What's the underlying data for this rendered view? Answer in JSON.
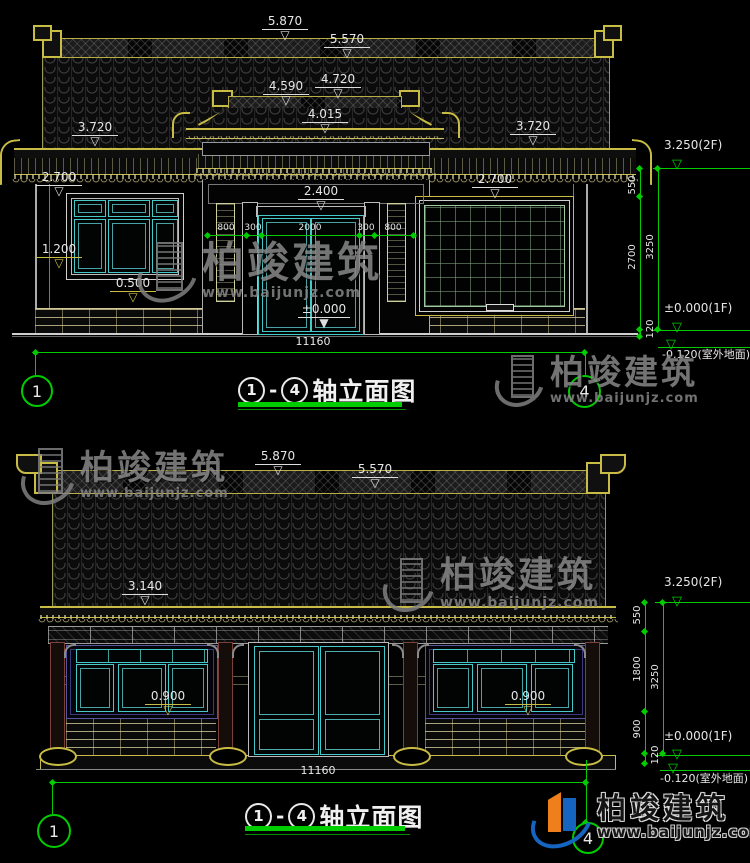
{
  "brand": {
    "name": "柏竣建筑",
    "url": "www.baijunjz.com"
  },
  "top": {
    "title": {
      "n1": "1",
      "dash": "-",
      "n2": "4",
      "label": "轴立面图"
    },
    "levels": {
      "v5870": "5.870",
      "v5570": "5.570",
      "v4720": "4.720",
      "v4590": "4.590",
      "v4015": "4.015",
      "v3720": "3.720",
      "v2700": "2.700",
      "v2400": "2.400",
      "v1200": "1.200",
      "v0500": "0.500",
      "v0000": "±0.000"
    },
    "width_chain": [
      "800",
      "300",
      "2000",
      "300",
      "800"
    ],
    "total_width": "11160",
    "axis_left": "1",
    "axis_right": "4",
    "chain": {
      "level2f": "3.250(2F)",
      "s550": "550",
      "s2700": "2700",
      "total": "3250",
      "s120": "120",
      "floor": "±0.000(1F)",
      "ground": "-0.120(室外地面)"
    }
  },
  "bottom": {
    "title": {
      "n1": "1",
      "dash": "-",
      "n2": "4",
      "label": "轴立面图"
    },
    "levels": {
      "v5870": "5.870",
      "v5570": "5.570",
      "v3140": "3.140",
      "v0900": "0.900"
    },
    "total_width": "11160",
    "axis_left": "1",
    "axis_right": "4",
    "chain": {
      "level2f": "3.250(2F)",
      "s550": "550",
      "s1800": "1800",
      "s900": "900",
      "total": "3250",
      "s120": "120",
      "floor": "±0.000(1F)",
      "ground": "-0.120(室外地面)"
    }
  }
}
